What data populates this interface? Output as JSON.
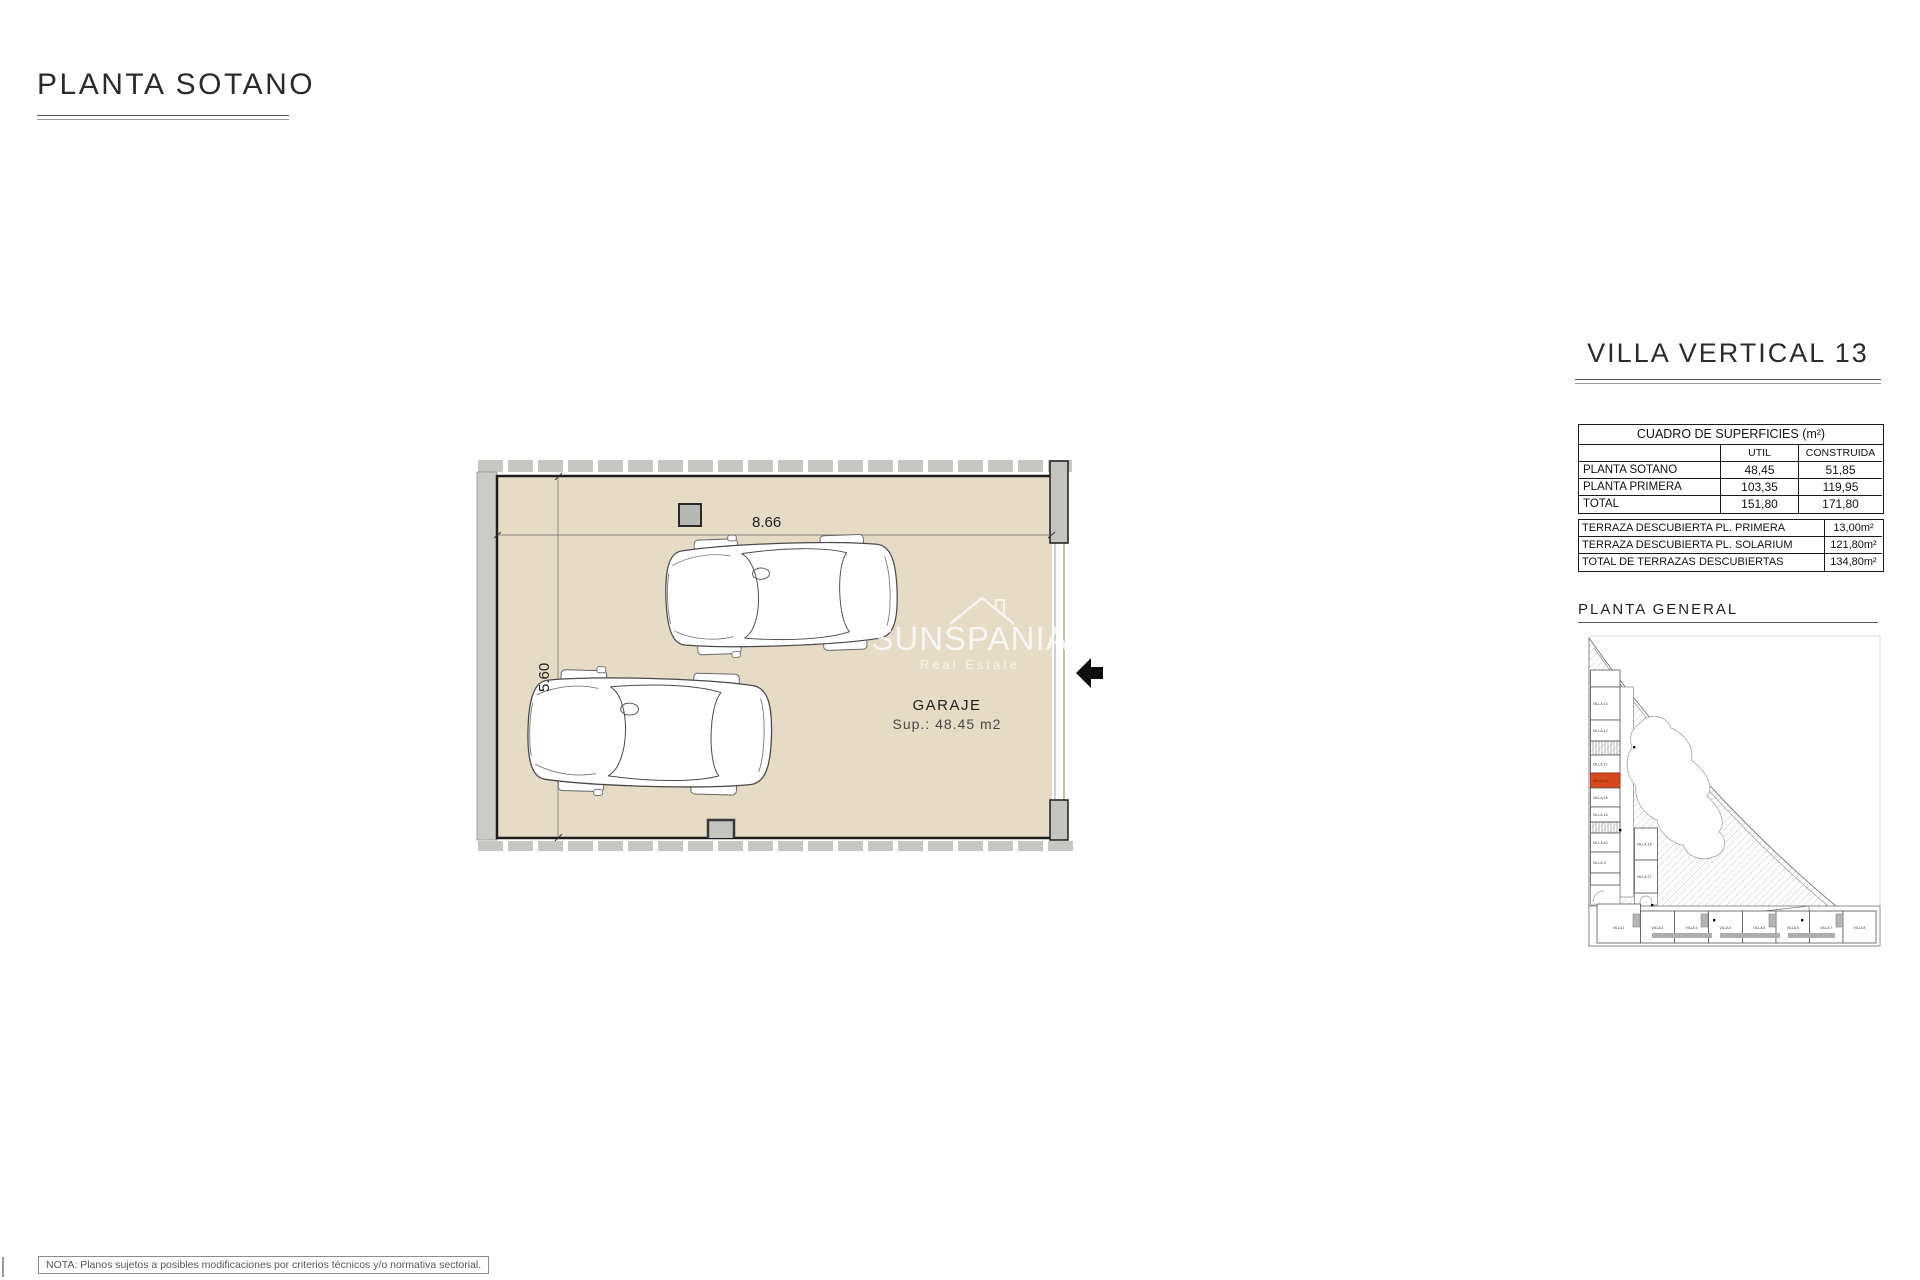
{
  "page": {
    "title": "PLANTA SOTANO",
    "note": "NOTA: Planos sujetos a posibles modificaciones por criterios técnicos y/o normativa sectorial."
  },
  "plan": {
    "room_label": "GARAJE",
    "room_area": "Sup.: 48.45 m2",
    "width_dim": "8.66",
    "height_dim": "5.60",
    "watermark": {
      "name": "SUNSPANIA",
      "tagline": "Real Estate"
    },
    "colors": {
      "floor": "#e5dbc6",
      "wall": "#c8c8c3"
    }
  },
  "sidebar": {
    "title": "VILLA VERTICAL 13",
    "surfaces": {
      "title": "CUADRO DE SUPERFICIES (m²)",
      "col_util": "UTIL",
      "col_construida": "CONSTRUIDA",
      "rows": [
        [
          "PLANTA SOTANO",
          "48,45",
          "51,85"
        ],
        [
          "PLANTA PRIMERA",
          "103,35",
          "119,95"
        ],
        [
          "TOTAL",
          "151,80",
          "171,80"
        ]
      ]
    },
    "terraces": {
      "rows": [
        [
          "TERRAZA DESCUBIERTA PL. PRIMERA",
          "13,00m²"
        ],
        [
          "TERRAZA DESCUBIERTA PL. SOLARIUM",
          "121,80m²"
        ],
        [
          "TOTAL DE TERRAZAS DESCUBIERTAS",
          "134,80m²"
        ]
      ]
    },
    "site_plan": {
      "title": "PLANTA  GENERAL",
      "highlighted": "VILLA 13",
      "highlight_color": "#d6491e",
      "left_villas": [
        "VILLA 14",
        "VILLA 12",
        "VILLA 11",
        "VILLA 13",
        "VILLA 15",
        "VILLA 16",
        "VILLA 10",
        "VILLA 9"
      ],
      "middle_villas": [
        "VILLA 18",
        "VILLA 17"
      ],
      "bottom_villas": [
        "VILLA 1",
        "VILLA 2",
        "VILLA 3",
        "VILLA 4",
        "VILLA 5",
        "VILLA 6",
        "VILLA 7",
        "VILLA 8"
      ]
    }
  }
}
